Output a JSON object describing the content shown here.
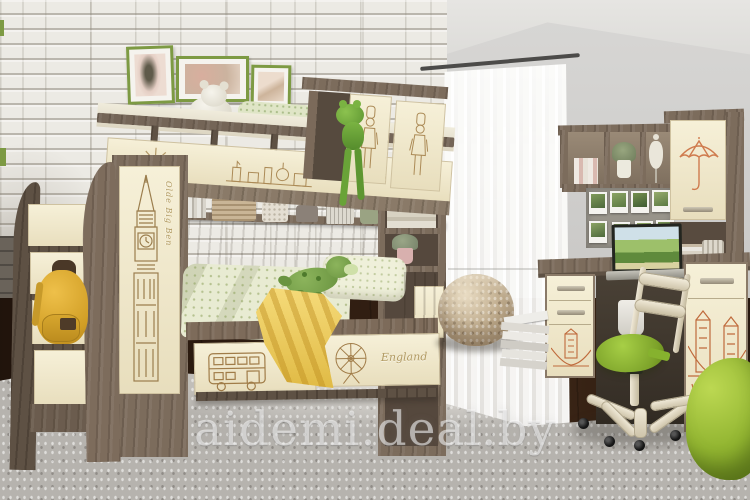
{
  "watermark": {
    "text": "aidemi.deal.by"
  },
  "decor_text": {
    "bunk_panel": "London",
    "wardrobe_vertical": "Olde Big Ben",
    "bed_drawer": "England"
  },
  "palette": {
    "wood": "#7c6c5c",
    "cream_panel": "#f2ebcf",
    "sketch_brown": "#a9854f",
    "sketch_orange": "#c06a42",
    "accent_green": "#8cbb33",
    "blanket_yellow": "#e8c54e",
    "brick_wall": "#eceae4",
    "grey_wall": "#cdccc9",
    "rug_grey": "#b6b3ae",
    "frame_green": "#7d9a43"
  },
  "objects": {
    "left_unit": "staircase chest with yellow backpack",
    "center_unit": "loft bunk bed with London decor and under-bed drawers",
    "right_unit": "desk with hutch, photo board and laptop",
    "seating": "green swivel chair, knitted pouf, green bean bag",
    "wall_decor": "three green framed pictures on white brick wall",
    "toys": "white teddy bear on top bunk, green dino plush on bed, frog plush on rail"
  }
}
